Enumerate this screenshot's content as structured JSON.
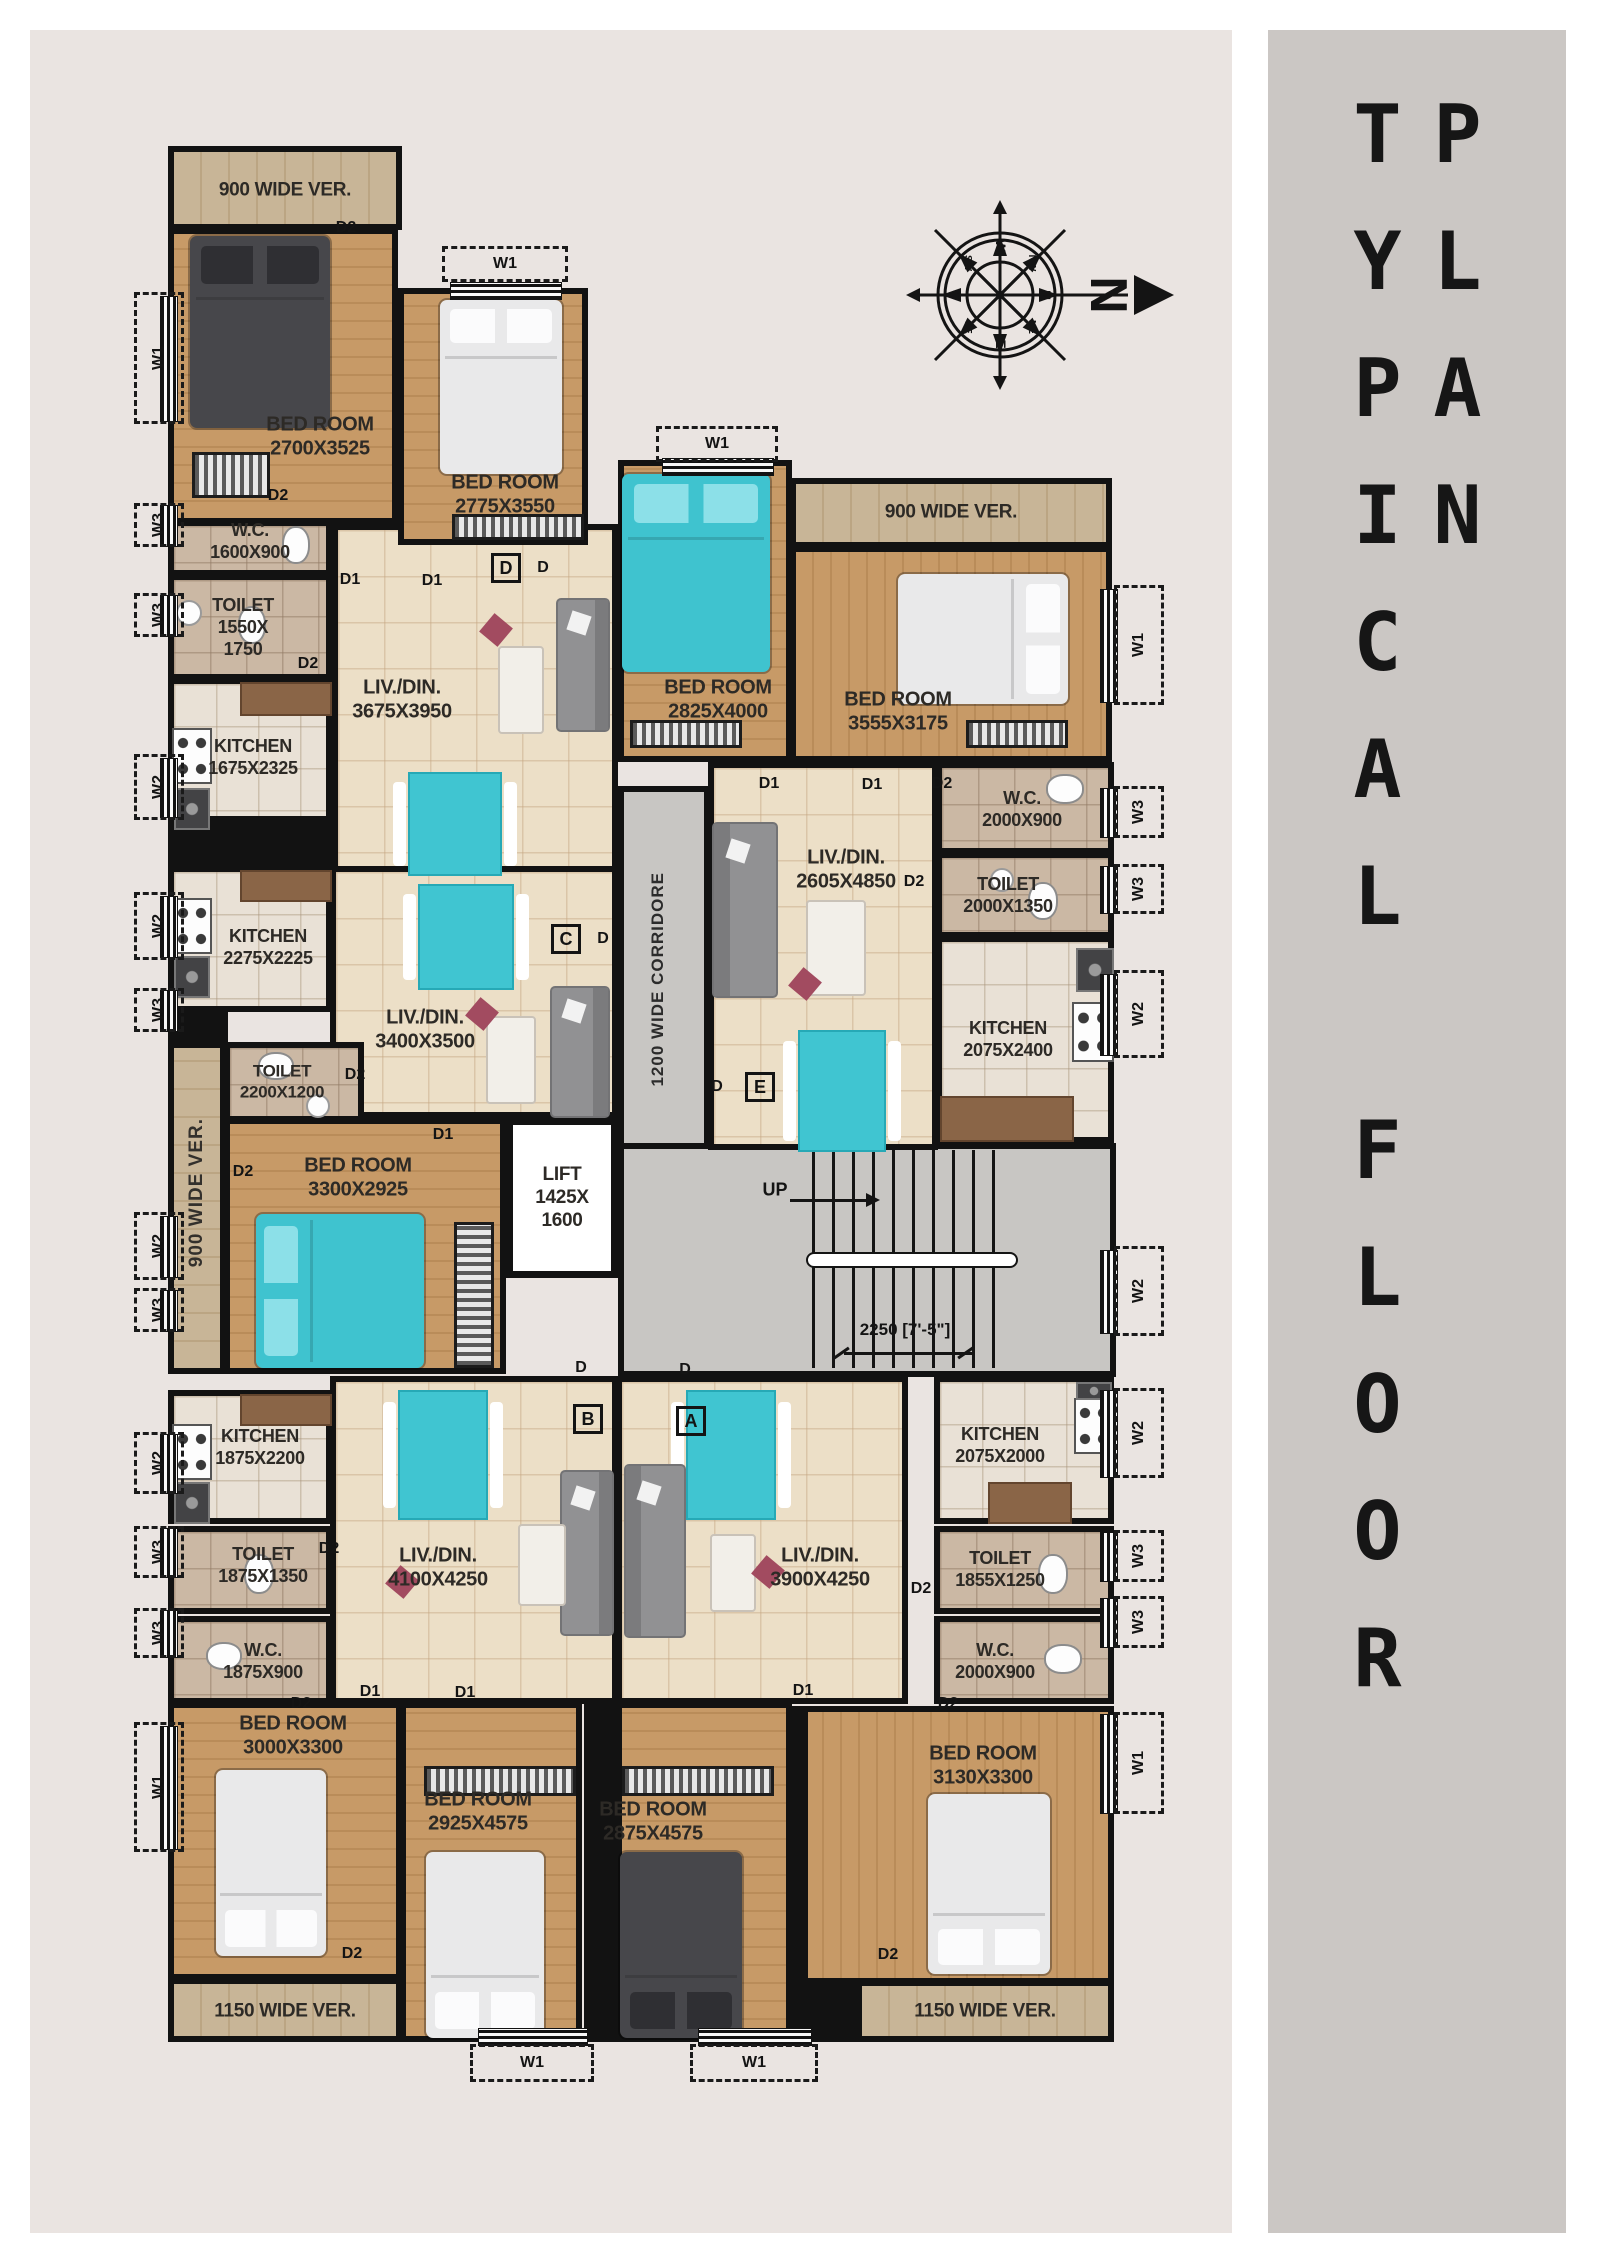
{
  "sidebar": {
    "title": "TYPICAL FLOOR PLAN"
  },
  "compass": {
    "big_n": "N",
    "n": "N",
    "s": "S",
    "e": "E",
    "w": "W",
    "ne": "NE",
    "nw": "NW",
    "se": "SE",
    "sw": "SW"
  },
  "corridor": {
    "label": "1200 WIDE CORRIDORE"
  },
  "stairs": {
    "up": "UP",
    "dimension": "2250 [7'-5\"]"
  },
  "lift": {
    "l1": "LIFT",
    "l2": "1425X",
    "l3": "1600"
  },
  "units": {
    "a": "A",
    "b": "B",
    "c": "C",
    "d": "D",
    "e": "E",
    "entry": "D"
  },
  "verandas": [
    {
      "label": "900 WIDE VER."
    },
    {
      "label": "900 WIDE VER."
    },
    {
      "label": "900 WIDE VER."
    },
    {
      "label": "1150 WIDE VER."
    },
    {
      "label": "1150 WIDE VER."
    }
  ],
  "rooms": [
    {
      "name": "BED ROOM",
      "dim": "2700X3525"
    },
    {
      "name": "BED ROOM",
      "dim": "2775X3550"
    },
    {
      "name": "BED ROOM",
      "dim": "2825X4000"
    },
    {
      "name": "BED ROOM",
      "dim": "3555X3175"
    },
    {
      "name": "W.C.",
      "dim": "1600X900"
    },
    {
      "name": "TOILET",
      "dim": "1550X",
      "dim2": "1750"
    },
    {
      "name": "KITCHEN",
      "dim": "1675X2325"
    },
    {
      "name": "LIV./DIN.",
      "dim": "3675X3950"
    },
    {
      "name": "KITCHEN",
      "dim": "2275X2225"
    },
    {
      "name": "LIV./DIN.",
      "dim": "3400X3500"
    },
    {
      "name": "TOILET",
      "dim": "2200X1200"
    },
    {
      "name": "BED ROOM",
      "dim": "3300X2925"
    },
    {
      "name": "W.C.",
      "dim": "2000X900"
    },
    {
      "name": "TOILET",
      "dim": "2000X1350"
    },
    {
      "name": "KITCHEN",
      "dim": "2075X2400"
    },
    {
      "name": "LIV./DIN.",
      "dim": "2605X4850"
    },
    {
      "name": "KITCHEN",
      "dim": "1875X2200"
    },
    {
      "name": "TOILET",
      "dim": "1875X1350"
    },
    {
      "name": "W.C.",
      "dim": "1875X900"
    },
    {
      "name": "LIV./DIN.",
      "dim": "4100X4250"
    },
    {
      "name": "BED ROOM",
      "dim": "3000X3300"
    },
    {
      "name": "BED ROOM",
      "dim": "2925X4575"
    },
    {
      "name": "LIV./DIN.",
      "dim": "3900X4250"
    },
    {
      "name": "KITCHEN",
      "dim": "2075X2000"
    },
    {
      "name": "TOILET",
      "dim": "1855X1250"
    },
    {
      "name": "W.C.",
      "dim": "2000X900"
    },
    {
      "name": "BED ROOM",
      "dim": "2875X4575"
    },
    {
      "name": "BED ROOM",
      "dim": "3130X3300"
    }
  ],
  "windows": [
    "W1",
    "W3",
    "W3",
    "W2",
    "W2",
    "W3",
    "W2",
    "W3",
    "W2",
    "W3",
    "W3",
    "W1",
    "W1",
    "W3",
    "W3",
    "W2",
    "W2",
    "W2",
    "W3",
    "W3",
    "W1",
    "W1",
    "W1",
    "W1",
    "W1"
  ],
  "doors": [
    "D2",
    "D2",
    "D2",
    "D1",
    "D1",
    "D1",
    "D1",
    "D2",
    "D2",
    "D2",
    "D2",
    "D1",
    "D2",
    "D2",
    "D1",
    "D1",
    "D1",
    "D2",
    "D2",
    "D2",
    "D2"
  ]
}
